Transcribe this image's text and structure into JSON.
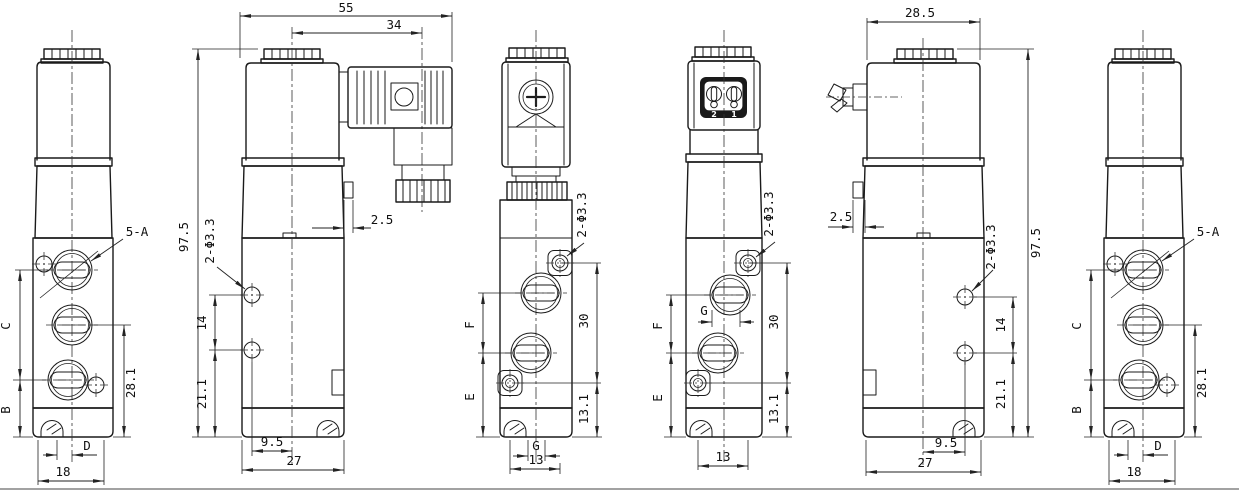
{
  "colors": {
    "line": "#1a1a1a",
    "dim": "#222222",
    "background": "#ffffff",
    "socket_fill": "#1a1a1a",
    "pin_text": "#ffffff"
  },
  "views": {
    "v1": {
      "callout_5a": "5-A",
      "dim_c": "C",
      "dim_b": "B",
      "dim_28_1": "28.1",
      "dim_d": "D",
      "dim_18": "18"
    },
    "v2": {
      "dim_55": "55",
      "dim_34": "34",
      "dim_97_5": "97.5",
      "hole_label": "2-Φ3.3",
      "dim_14": "14",
      "dim_21_1": "21.1",
      "dim_2_5": "2.5",
      "dim_9_5": "9.5",
      "dim_27": "27"
    },
    "v3": {
      "hole_label": "2-Φ3.3",
      "dim_f": "F",
      "dim_e": "E",
      "dim_30": "30",
      "dim_13_1": "13.1",
      "dim_g": "G",
      "dim_13": "13"
    },
    "v4": {
      "pin_2": "2",
      "pin_1": "1",
      "hole_label": "2-Φ3.3",
      "dim_f": "F",
      "dim_e": "E",
      "dim_g": "G",
      "dim_30": "30",
      "dim_13_1": "13.1",
      "dim_13": "13"
    },
    "v5": {
      "dim_28_5": "28.5",
      "dim_2_5": "2.5",
      "hole_label": "2-Φ3.3",
      "dim_97_5": "97.5",
      "dim_14": "14",
      "dim_21_1": "21.1",
      "dim_9_5": "9.5",
      "dim_27": "27"
    },
    "v6": {
      "callout_5a": "5-A",
      "dim_c": "C",
      "dim_b": "B",
      "dim_28_1": "28.1",
      "dim_d": "D",
      "dim_18": "18"
    }
  }
}
